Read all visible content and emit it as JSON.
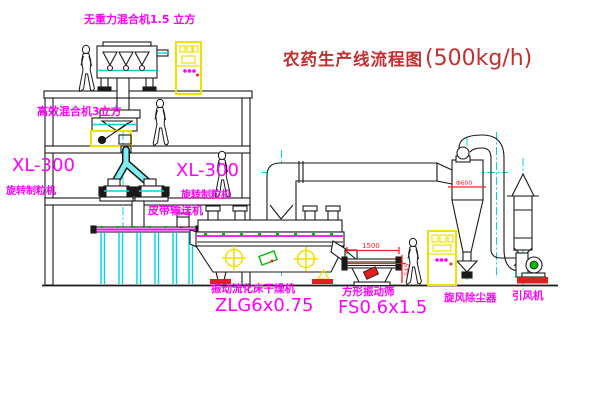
{
  "diagram": {
    "title": {
      "zh": "农药生产线流程图",
      "capacity": "(500kg/h)"
    },
    "labels": {
      "gravity_mixer": "无重力混合机1.5 立方",
      "high_eff_mixer": "高效混合机3立方",
      "granulator_model_left": "XL-300",
      "granulator_name_left": "旋转制粒机",
      "granulator_model_right": "XL-300",
      "granulator_name_right": "旋转制粒机",
      "belt_conveyor": "皮带输送机",
      "dryer_name": "振动流化床干燥机",
      "dryer_model": "ZLG6x0.75",
      "screen_name": "方形振动筛",
      "screen_model": "FS0.6x1.5",
      "cyclone": "旋风除尘器",
      "fan": "引风机"
    },
    "dimensions": {
      "screen_width": "1500",
      "screen_height": "545",
      "cyclone_diameter": "Φ600"
    },
    "colors": {
      "label_magenta": "#ff00ff",
      "title_red": "#c03030",
      "centerline_cyan": "#00d4e0",
      "highlight_yellow": "#f0e000",
      "dimension_red": "#ff2020",
      "accent_green": "#00bb00",
      "line_black": "#1a1a1a"
    }
  }
}
